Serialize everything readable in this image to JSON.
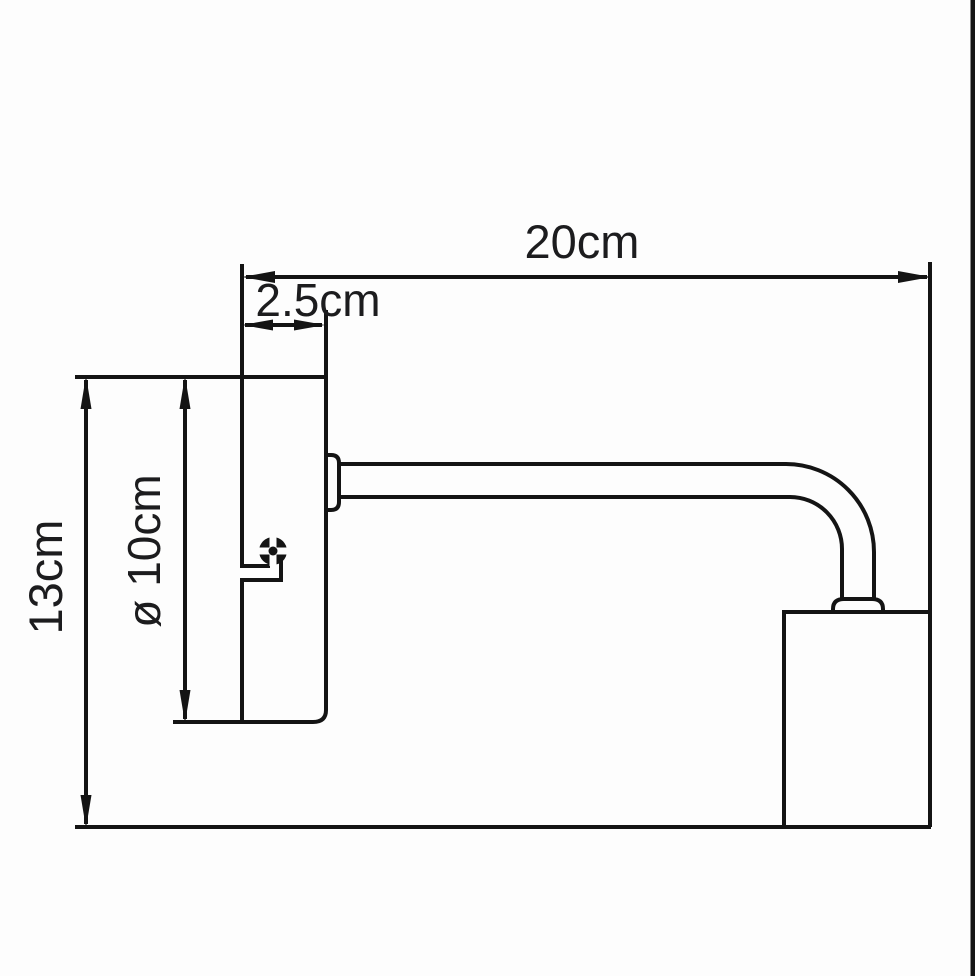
{
  "diagram": {
    "kind": "technical dimension drawing",
    "subject": "wall lamp side profile with mounting plate, curved arm and lamp head",
    "background_color": "#fdfdfd",
    "line_color": "#141414",
    "text_color": "#1c1c1e",
    "dimensions": {
      "overall_width": {
        "label": "20cm",
        "value": 20,
        "unit": "cm",
        "orientation": "horizontal"
      },
      "plate_thickness": {
        "label": "2.5cm",
        "value": 2.5,
        "unit": "cm",
        "orientation": "horizontal"
      },
      "overall_height": {
        "label": "13cm",
        "value": 13,
        "unit": "cm",
        "orientation": "vertical"
      },
      "plate_diameter": {
        "label": "ø 10cm",
        "value": 10,
        "unit": "cm",
        "orientation": "vertical"
      }
    }
  }
}
